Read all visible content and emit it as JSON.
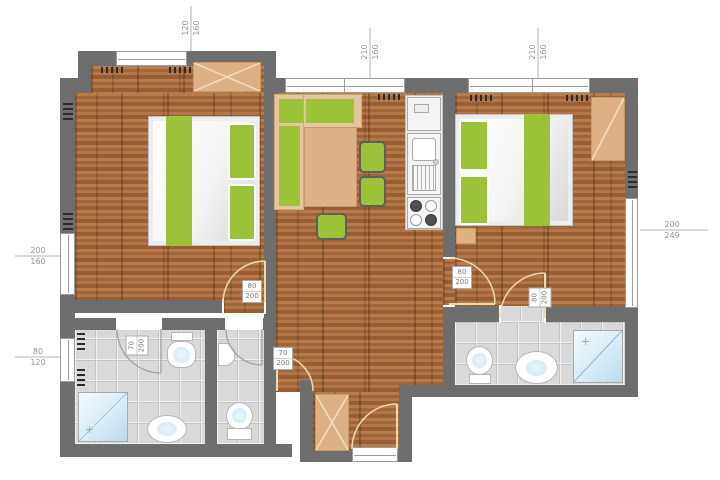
{
  "colors": {
    "wall": "#6e6e6e",
    "wood_floor": "#aa7044",
    "tile_floor": "#d9d9d9",
    "furniture_green": "#9cc23a",
    "furniture_tan": "#ddb183",
    "water_blue": "#cfe6f4",
    "dimension_text": "#949494"
  },
  "window_dimensions": {
    "bedroom1_top": {
      "width": "120",
      "height": "160"
    },
    "living_room": {
      "width": "210",
      "height": "160"
    },
    "bedroom2_top": {
      "width": "210",
      "height": "160"
    },
    "bedroom1_side": {
      "width": "200",
      "height": "160"
    },
    "bathroom1_side": {
      "width": "80",
      "height": "120"
    },
    "bedroom2_side": {
      "width": "200",
      "height": "249"
    }
  },
  "door_dimensions": {
    "bedroom1": {
      "width": "80",
      "height": "200"
    },
    "bedroom2": {
      "width": "80",
      "height": "200"
    },
    "bathroom2": {
      "width": "80",
      "height": "200"
    },
    "bathroom1": {
      "width": "70",
      "height": "200"
    },
    "hall": {
      "width": "70",
      "height": "200"
    }
  }
}
